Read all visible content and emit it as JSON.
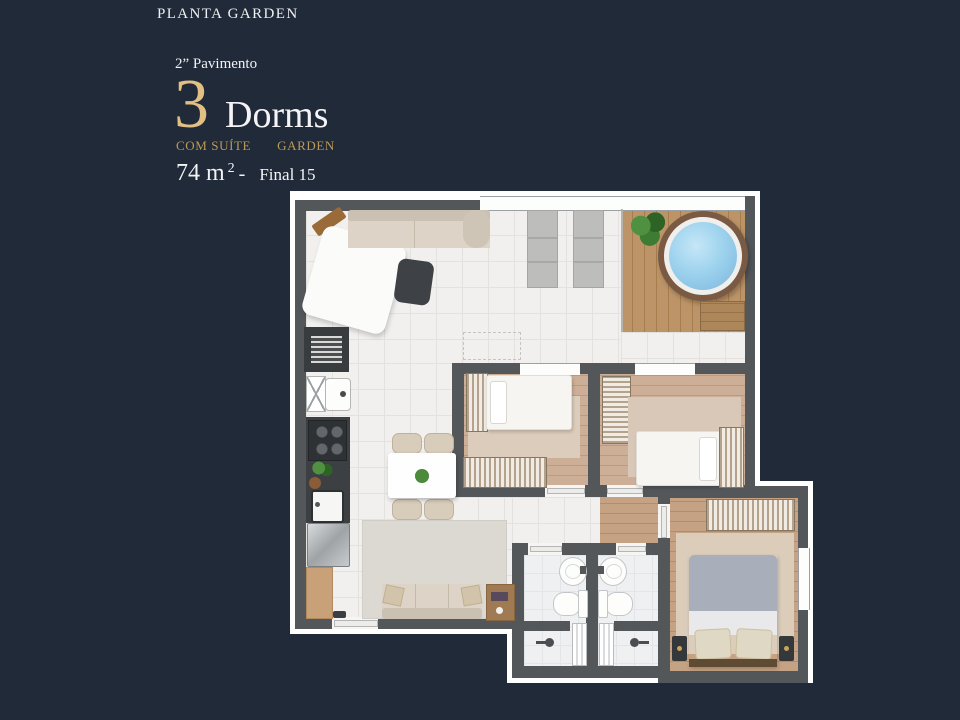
{
  "slide": {
    "background": "#212a39",
    "header": {
      "title": "PLANTA GARDEN"
    },
    "info": {
      "pavimento": "2” Pavimento",
      "dorms_number": "3",
      "dorms_label": "Dorms",
      "tag_suite": "COM SUÍTE",
      "tag_garden": "GARDEN",
      "area_value": "74 m",
      "area_superscript": "2",
      "area_separator": "-",
      "final_label": "Final 15"
    },
    "colors": {
      "gold_large": "#e2c083",
      "gold_small": "#bb9a55",
      "text": "#f1f2f4"
    }
  },
  "floorplan": {
    "elements": [
      "garden-deck",
      "jacuzzi",
      "plant",
      "sun-loungers",
      "living-sofa",
      "floor-lamp",
      "chaise",
      "armchair",
      "kitchen-counter",
      "stove",
      "kitchen-sink",
      "fridge",
      "laundry-tank",
      "washer",
      "dining-table",
      "dining-chairs",
      "living-rug",
      "bottom-sofa",
      "side-table",
      "bedroom-1-bed",
      "bedroom-1-wardrobe",
      "bedroom-2-bed",
      "bedroom-2-wardrobe",
      "suite-bed",
      "suite-wardrobe",
      "nightstands",
      "bathroom-sinks",
      "toilets",
      "showers",
      "glass-doors",
      "entry-door"
    ],
    "colors": {
      "wall": "#53575a",
      "tile": "#f1f0ee",
      "deck_wood": "#bc9468",
      "bedroom_wood": "#cdaf97",
      "water": "#8cc7e8",
      "jacuzzi_ring": "#7a5a42"
    }
  }
}
